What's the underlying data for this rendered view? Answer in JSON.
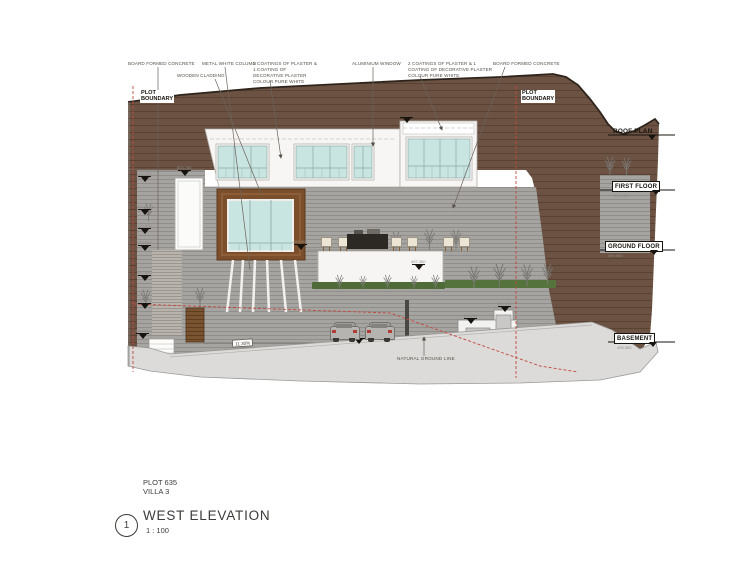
{
  "title_block": {
    "plot_and_villa": "PLOT 635\nVILLA 3",
    "view_number": "1",
    "view_title": "WEST ELEVATION",
    "scale": "1 : 100"
  },
  "annotations": {
    "top_labels": [
      "BOARD FORMED CONCRETE",
      "WOODEN CLADDING",
      "METAL WHITE COLUMN",
      "2 COATINGS OF PLASTER &\n1 COATING OF\nDECORATIVE PLASTER\nCOLOUR PURE WHITE",
      "ALUMINIUM WINDOW",
      "2 COATINGS OF PLASTER & 1\nCOATING OF DECORATIVE PLASTER\nCOLOUR PURE WHITE",
      "BOARD FORMED CONCRETE"
    ],
    "plot_boundary_left": "PLOT\nBOUNDARY",
    "plot_boundary_right": "PLOT\nBOUNDARY",
    "natural_ground_line": "NATURAL GROUND LINE",
    "ramp_slope": "11.30%"
  },
  "levels": [
    {
      "label": "ROOF PLAN",
      "elevation": ""
    },
    {
      "label": "FIRST FLOOR",
      "elevation": "503.400"
    },
    {
      "label": "GROUND FLOOR",
      "elevation": "499.500"
    },
    {
      "label": "BASEMENT",
      "elevation": "495.300"
    }
  ],
  "spot_elevations": [
    "504.750",
    "503.650",
    "501.500",
    "500.500",
    "499.500",
    "497.500",
    "495.500",
    "493.500",
    "498.500",
    "497.300",
    "495.250",
    "495.450",
    "",
    ""
  ],
  "colors": {
    "earth": "#6b5243",
    "retaining_wall": "#a6a4a1",
    "glazing": "#c8e5e1",
    "wood_cladding": "#7b4f2c",
    "hedge": "#4f6c38",
    "plot_boundary_line": "#c3483c",
    "ground": "#dcdbd9"
  }
}
